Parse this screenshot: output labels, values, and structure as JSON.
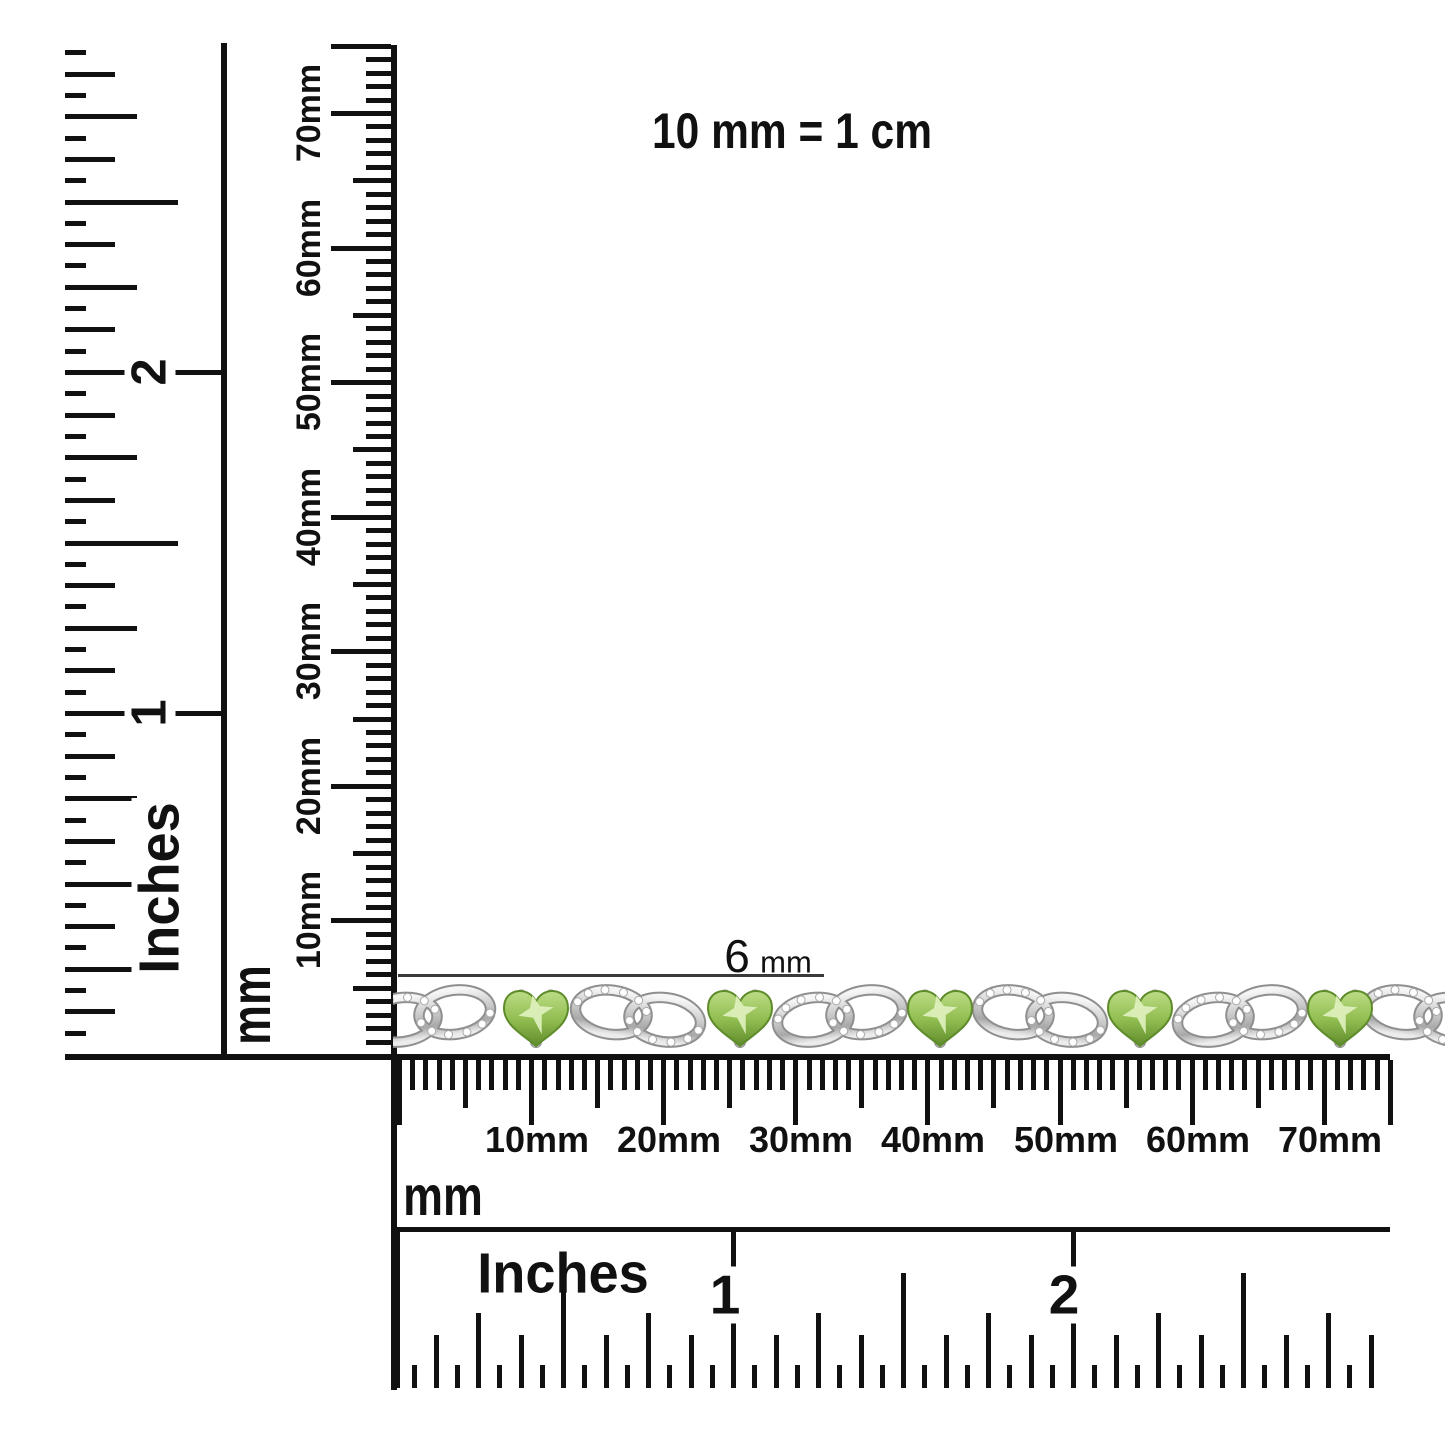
{
  "scale_note": "10 mm = 1 cm",
  "annotation": {
    "value": "6",
    "unit": "mm"
  },
  "rulers": {
    "left_inches": {
      "unit": "Inches",
      "labels": [
        "1",
        "2"
      ]
    },
    "vertical_mm": {
      "unit": "mm",
      "labels": [
        "10mm",
        "20mm",
        "30mm",
        "40mm",
        "50mm",
        "60mm",
        "70mm"
      ]
    },
    "horizontal_mm": {
      "unit": "mm",
      "labels": [
        "10mm",
        "20mm",
        "30mm",
        "40mm",
        "50mm",
        "60mm",
        "70mm"
      ]
    },
    "bottom_inches": {
      "unit": "Inches",
      "labels": [
        "1",
        "2"
      ]
    }
  },
  "product": {
    "description": "silver infinity-link bracelet with heart-cut peridot gemstones and diamond accents",
    "colors": {
      "ink": "#111111",
      "annotation_line": "#3a3a3a",
      "gem": "#93bf53",
      "gem_light": "#ddefbc",
      "gem_dark": "#5f8c2b",
      "metal": "#c9c9c9",
      "metal_dark": "#8f8f8f",
      "diamond": "#ffffff"
    }
  }
}
